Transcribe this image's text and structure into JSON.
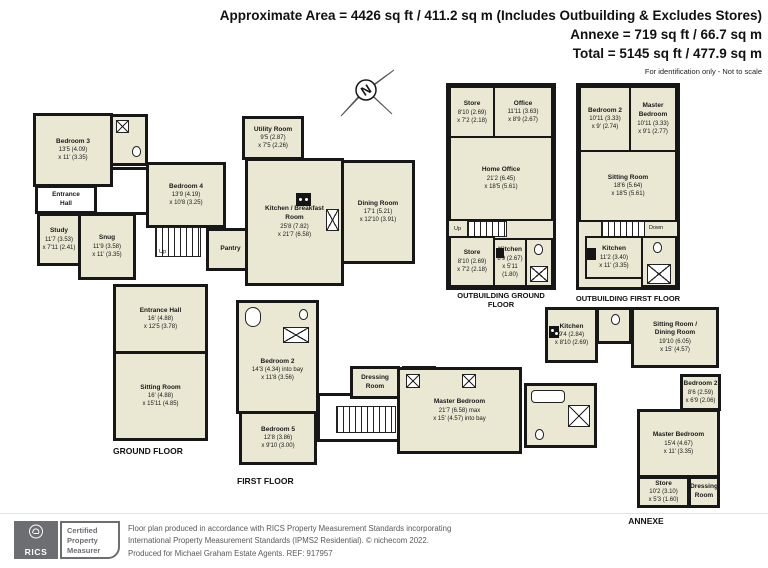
{
  "header": {
    "area_line": "Approximate Area = 4426 sq ft / 411.2 sq m (Includes Outbuilding & Excludes Stores)",
    "annexe_line": "Annexe = 719 sq ft / 66.7 sq m",
    "total_line": "Total = 5145 sq ft / 477.9 sq m",
    "disclaimer": "For identification only - Not to scale"
  },
  "compass": {
    "north_label": "N"
  },
  "ground_floor": {
    "label": "GROUND FLOOR",
    "stairs_label": "Up",
    "rooms": {
      "bedroom3": {
        "name": "Bedroom 3",
        "d1": "13'5 (4.09)",
        "d2": "x 11' (3.35)"
      },
      "entrance_hall_small": {
        "name": "Entrance Hall"
      },
      "study": {
        "name": "Study",
        "d1": "11'7 (3.53)",
        "d2": "x 7'11 (2.41)"
      },
      "snug": {
        "name": "Snug",
        "d1": "11'9 (3.58)",
        "d2": "x 11' (3.35)"
      },
      "bedroom4": {
        "name": "Bedroom 4",
        "d1": "13'9 (4.19)",
        "d2": "x 10'8 (3.25)"
      },
      "utility_room": {
        "name": "Utility Room",
        "d1": "9'5 (2.87)",
        "d2": "x 7'5 (2.26)"
      },
      "pantry": {
        "name": "Pantry"
      },
      "kitchen_breakfast": {
        "name": "Kitchen / Breakfast Room",
        "d1": "25'8 (7.82)",
        "d2": "x 21'7 (6.58)"
      },
      "dining_room": {
        "name": "Dining Room",
        "d1": "17'1 (5.21)",
        "d2": "x 12'10 (3.91)"
      },
      "entrance_hall": {
        "name": "Entrance Hall",
        "d1": "16' (4.88)",
        "d2": "x 12'5 (3.78)"
      },
      "sitting_room": {
        "name": "Sitting Room",
        "d1": "16' (4.88)",
        "d2": "x 15'11 (4.85)"
      }
    }
  },
  "first_floor": {
    "label": "FIRST FLOOR",
    "stairs_label": "Down",
    "rooms": {
      "bedroom2": {
        "name": "Bedroom 2",
        "d1": "14'3 (4.34) into bay",
        "d2": "x 11'8 (3.56)"
      },
      "bedroom5": {
        "name": "Bedroom 5",
        "d1": "12'8 (3.86)",
        "d2": "x 9'10 (3.00)"
      },
      "dressing_room": {
        "name": "Dressing Room"
      },
      "master_bedroom": {
        "name": "Master Bedroom",
        "d1": "21'7 (6.58) max",
        "d2": "x 15' (4.57) into bay"
      }
    }
  },
  "outbuilding_ground": {
    "label": "OUTBUILDING GROUND FLOOR",
    "stairs_label": "Up",
    "rooms": {
      "store_top": {
        "name": "Store",
        "d1": "8'10 (2.69)",
        "d2": "x 7'2 (2.18)"
      },
      "office": {
        "name": "Office",
        "d1": "11'11 (3.63)",
        "d2": "x 8'9 (2.67)"
      },
      "home_office": {
        "name": "Home Office",
        "d1": "21'2 (6.45)",
        "d2": "x 18'5 (5.61)"
      },
      "store_bottom": {
        "name": "Store",
        "d1": "8'10 (2.69)",
        "d2": "x 7'2 (2.18)"
      },
      "kitchen": {
        "name": "Kitchen",
        "d1": "8'9 (2.67)",
        "d2": "x 5'11 (1.80)"
      }
    }
  },
  "outbuilding_first": {
    "label": "OUTBUILDING FIRST FLOOR",
    "stairs_label": "Down",
    "rooms": {
      "bedroom2": {
        "name": "Bedroom 2",
        "d1": "10'11 (3.33)",
        "d2": "x 9' (2.74)"
      },
      "master_bedroom": {
        "name": "Master Bedroom",
        "d1": "10'11 (3.33)",
        "d2": "x 9'1 (2.77)"
      },
      "sitting_room": {
        "name": "Sitting Room",
        "d1": "18'6 (5.64)",
        "d2": "x 18'5 (5.61)"
      },
      "kitchen": {
        "name": "Kitchen",
        "d1": "11'2 (3.40)",
        "d2": "x 11' (3.35)"
      }
    }
  },
  "annexe": {
    "label": "ANNEXE",
    "rooms": {
      "kitchen": {
        "name": "Kitchen",
        "d1": "9'4 (2.84)",
        "d2": "x 8'10 (2.69)"
      },
      "sitting_dining": {
        "name": "Sitting Room / Dining Room",
        "d1": "19'10 (6.05)",
        "d2": "x 15' (4.57)"
      },
      "bedroom2": {
        "name": "Bedroom 2",
        "d1": "8'6 (2.59)",
        "d2": "x 6'9 (2.06)"
      },
      "master_bedroom": {
        "name": "Master Bedroom",
        "d1": "15'4 (4.67)",
        "d2": "x 11' (3.35)"
      },
      "store": {
        "name": "Store",
        "d1": "10'2 (3.10)",
        "d2": "x 5'3 (1.60)"
      },
      "dressing_room": {
        "name": "Dressing Room"
      }
    }
  },
  "footer": {
    "rics_brand": "RICS",
    "badge_label": "Certified Property Measurer",
    "line1": "Floor plan produced in accordance with RICS Property Measurement Standards incorporating",
    "line2": "International Property Measurement Standards (IPMS2 Residential).  © nichecom 2022.",
    "line3": "Produced for Michael Graham Estate Agents.  REF: 917957"
  },
  "colors": {
    "room_fill": "#eae7d2",
    "wall": "#171717",
    "footer_gray": "#6d6e71"
  }
}
